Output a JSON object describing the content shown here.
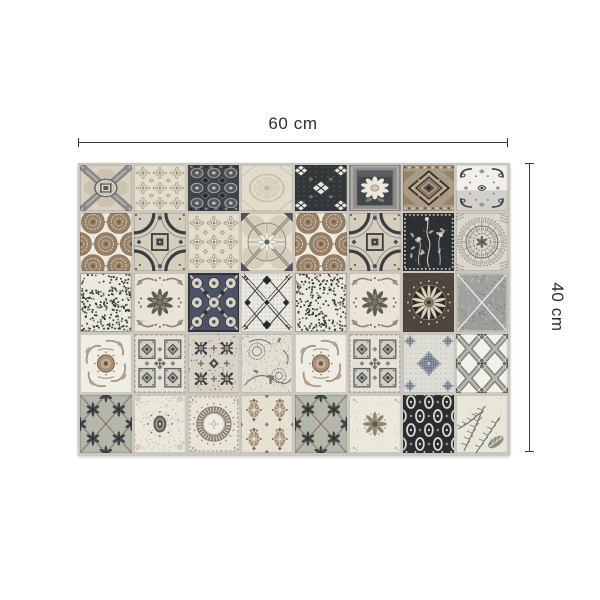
{
  "image_type": "product photo: patchwork cement-tile style mat with dimension annotations",
  "annotations": {
    "width_label": "60 cm",
    "height_label": "40 cm",
    "line_color": "#3c3c3c",
    "text_color": "#2e2e2e"
  },
  "panel": {
    "columns": 8,
    "rows": 5,
    "grout_color": "#c9c7c0",
    "palette": {
      "cream": "#ece8db",
      "beige": "#ddd5c4",
      "sand": "#cfc6b2",
      "taupe": "#ab9a84",
      "brown": "#988066",
      "umber": "#6e5c48",
      "ink": "#2e3234",
      "charcoal": "#43474b",
      "slate": "#6e7173",
      "gray": "#8f918e",
      "silver": "#c6c4bd",
      "bluegray": "#6e7a8c",
      "sage": "#b4b7ab",
      "white": "#f4f2ec"
    },
    "tiles": [
      "diagonal-cross-medallion",
      "floral-lattice",
      "dense-geometric-dark",
      "faded-ornament",
      "star-cross-dark",
      "framed-flower",
      "diamond-taupe",
      "scroll-corners",
      "lace-circles",
      "astroid-frame",
      "floral-lattice",
      "compass-circle",
      "lace-circles",
      "astroid-frame",
      "botanical-dark",
      "lace-medallion",
      "noise-maze",
      "rosette-swirl",
      "kaleido-navy",
      "checker-x",
      "noise-maze",
      "rosette-swirl",
      "radiant-medallion-dark",
      "mesh-diagonal",
      "rose-swirl-medallion",
      "octagon-grid",
      "kaleido-dense",
      "paisley-dense",
      "rose-swirl-medallion",
      "octagon-grid",
      "snowflake-pixel",
      "quatrefoil-trellis",
      "sage-diamond-floral",
      "speckle-medallion",
      "wreath-circle",
      "damask-brown",
      "sage-diamond-floral",
      "rosette-light",
      "ogee-dark",
      "fern-leaves"
    ]
  }
}
